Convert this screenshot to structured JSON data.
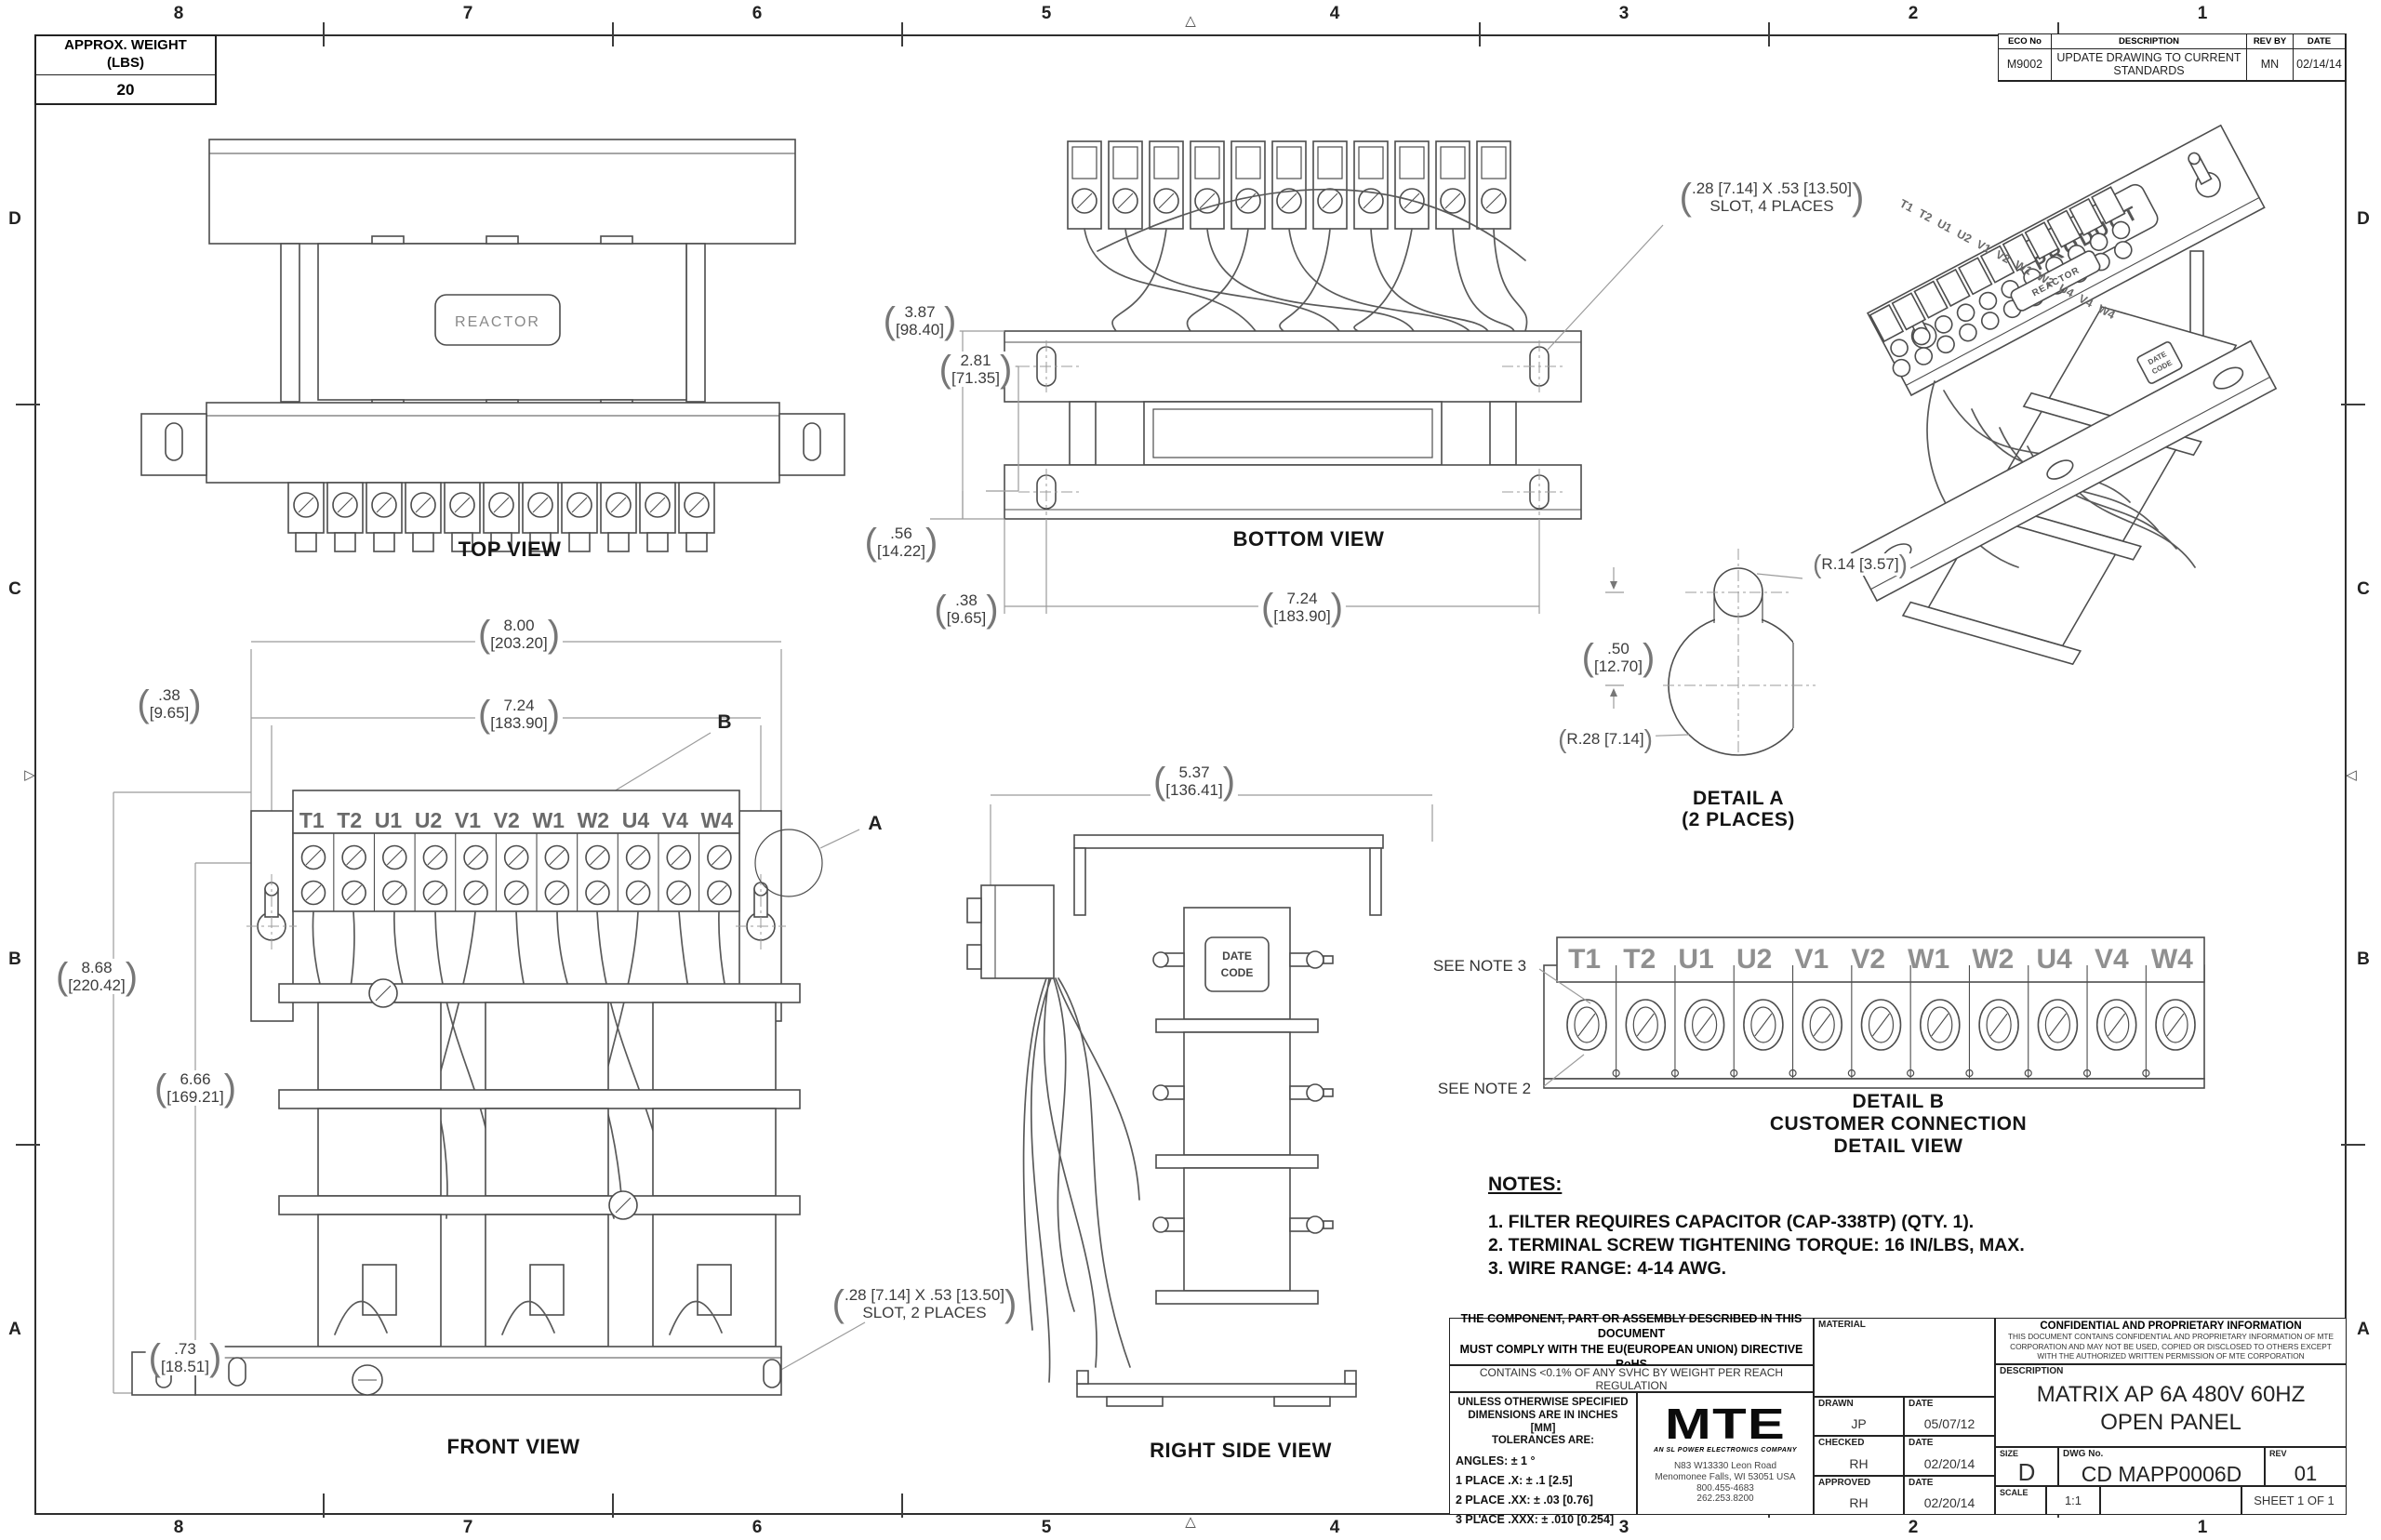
{
  "sheet": {
    "zones": {
      "cols": [
        "8",
        "7",
        "6",
        "5",
        "4",
        "3",
        "2",
        "1"
      ],
      "rows": [
        "D",
        "C",
        "B",
        "A"
      ]
    },
    "weight_box": {
      "line1": "APPROX. WEIGHT",
      "line2": "(LBS)",
      "value": "20"
    },
    "eco": {
      "h_no": "ECO No",
      "h_desc": "DESCRIPTION",
      "h_rev": "REV BY",
      "h_date": "DATE",
      "no": "M9002",
      "desc1": "UPDATE DRAWING TO CURRENT",
      "desc2": "STANDARDS",
      "rev": "MN",
      "date": "02/14/14"
    }
  },
  "terminals": [
    "T1",
    "T2",
    "U1",
    "U2",
    "V1",
    "V2",
    "W1",
    "W2",
    "U4",
    "V4",
    "W4"
  ],
  "captions": {
    "top": "TOP VIEW",
    "bottom": "BOTTOM VIEW",
    "front": "FRONT VIEW",
    "right": "RIGHT SIDE VIEW",
    "detail_a1": "DETAIL A",
    "detail_a2": "(2 PLACES)",
    "detail_b1": "DETAIL B",
    "detail_b2": "CUSTOMER CONNECTION",
    "detail_b3": "DETAIL VIEW"
  },
  "labels": {
    "reactor": "REACTOR",
    "product": "PRODUCT",
    "date_code1": "DATE",
    "date_code2": "CODE",
    "see_note3": "SEE NOTE 3",
    "see_note2": "SEE NOTE 2",
    "callout_a": "A",
    "callout_b": "B"
  },
  "dims": {
    "bv_h": {
      "in": "3.87",
      "mm": "[98.40]"
    },
    "bv_hc": {
      "in": "2.81",
      "mm": "[71.35]"
    },
    "bv_e": {
      "in": ".56",
      "mm": "[14.22]"
    },
    "bv_o": {
      "in": ".38",
      "mm": "[9.65]"
    },
    "bv_w": {
      "in": "7.24",
      "mm": "[183.90]"
    },
    "fv_w": {
      "in": "8.00",
      "mm": "[203.20]"
    },
    "fv_wc": {
      "in": "7.24",
      "mm": "[183.90]"
    },
    "fv_o": {
      "in": ".38",
      "mm": "[9.65]"
    },
    "fv_h": {
      "in": "8.68",
      "mm": "[220.42]"
    },
    "fv_hc": {
      "in": "6.66",
      "mm": "[169.21]"
    },
    "fv_b": {
      "in": ".73",
      "mm": "[18.51]"
    },
    "rv_d": {
      "in": "5.37",
      "mm": "[136.41]"
    },
    "da_off": {
      "in": ".50",
      "mm": "[12.70]"
    },
    "da_r1": "R.14 [3.57]",
    "da_r2": "R.28 [7.14]",
    "slot4_1": ".28 [7.14]  X .53 [13.50]",
    "slot4_2": "SLOT, 4 PLACES",
    "slot2_1": ".28 [7.14]  X .53 [13.50]",
    "slot2_2": "SLOT, 2 PLACES"
  },
  "notes": {
    "title": "NOTES:",
    "items": [
      "1.   FILTER REQUIRES CAPACITOR (CAP-338TP) (QTY. 1).",
      "2.   TERMINAL SCREW TIGHTENING TORQUE: 16 IN/LBS, MAX.",
      "3.   WIRE RANGE: 4-14 AWG."
    ]
  },
  "title_block": {
    "rohs1": "THE COMPONENT, PART OR ASSEMBLY DESCRIBED IN THIS DOCUMENT",
    "rohs2": "MUST COMPLY WITH THE EU(EUROPEAN UNION) DIRECTIVE RoHS",
    "reach": "CONTAINS <0.1% OF ANY SVHC BY WEIGHT PER REACH REGULATION",
    "tol_h1": "UNLESS OTHERWISE SPECIFIED",
    "tol_h2": "DIMENSIONS ARE IN INCHES [MM]",
    "tol_h3": "TOLERANCES ARE:",
    "tol_angles": "ANGLES: ± 1 °",
    "tol_1": "1 PLACE .X: ± .1 [2.5]",
    "tol_2": "2 PLACE .XX: ± .03 [0.76]",
    "tol_3": "3 PLACE .XXX: ± .010 [0.254]",
    "logo_text": "MTE",
    "logo_tagline": "AN SL POWER ELECTRONICS COMPANY",
    "addr1": "N83 W13330 Leon Road",
    "addr2": "Menomonee Falls, WI 53051 USA",
    "addr3": "800.455-4683",
    "addr4": "262.253.8200",
    "material_label": "MATERIAL",
    "drawn_label": "DRAWN",
    "drawn": "JP",
    "drawn_date_label": "DATE",
    "drawn_date": "05/07/12",
    "checked_label": "CHECKED",
    "checked": "RH",
    "checked_date_label": "DATE",
    "checked_date": "02/20/14",
    "approved_label": "APPROVED",
    "approved": "RH",
    "approved_date_label": "DATE",
    "approved_date": "02/20/14",
    "conf_title": "CONFIDENTIAL AND PROPRIETARY INFORMATION",
    "conf1": "THIS DOCUMENT CONTAINS CONFIDENTIAL AND PROPRIETARY INFORMATION OF MTE",
    "conf2": "CORPORATION AND MAY NOT BE USED, COPIED OR DISCLOSED TO OTHERS EXCEPT",
    "conf3": "WITH THE AUTHORIZED WRITTEN PERMISSION OF MTE CORPORATION",
    "desc_label": "DESCRIPTION",
    "desc1": "MATRIX AP 6A 480V 60HZ",
    "desc2": "OPEN PANEL",
    "size_label": "SIZE",
    "size": "D",
    "dwg_label": "DWG No.",
    "dwg_no": "CD MAPP0006D",
    "rev_label": "REV",
    "rev": "01",
    "scale_label": "SCALE",
    "scale": "1:1",
    "sheet": "SHEET 1  OF 1"
  }
}
